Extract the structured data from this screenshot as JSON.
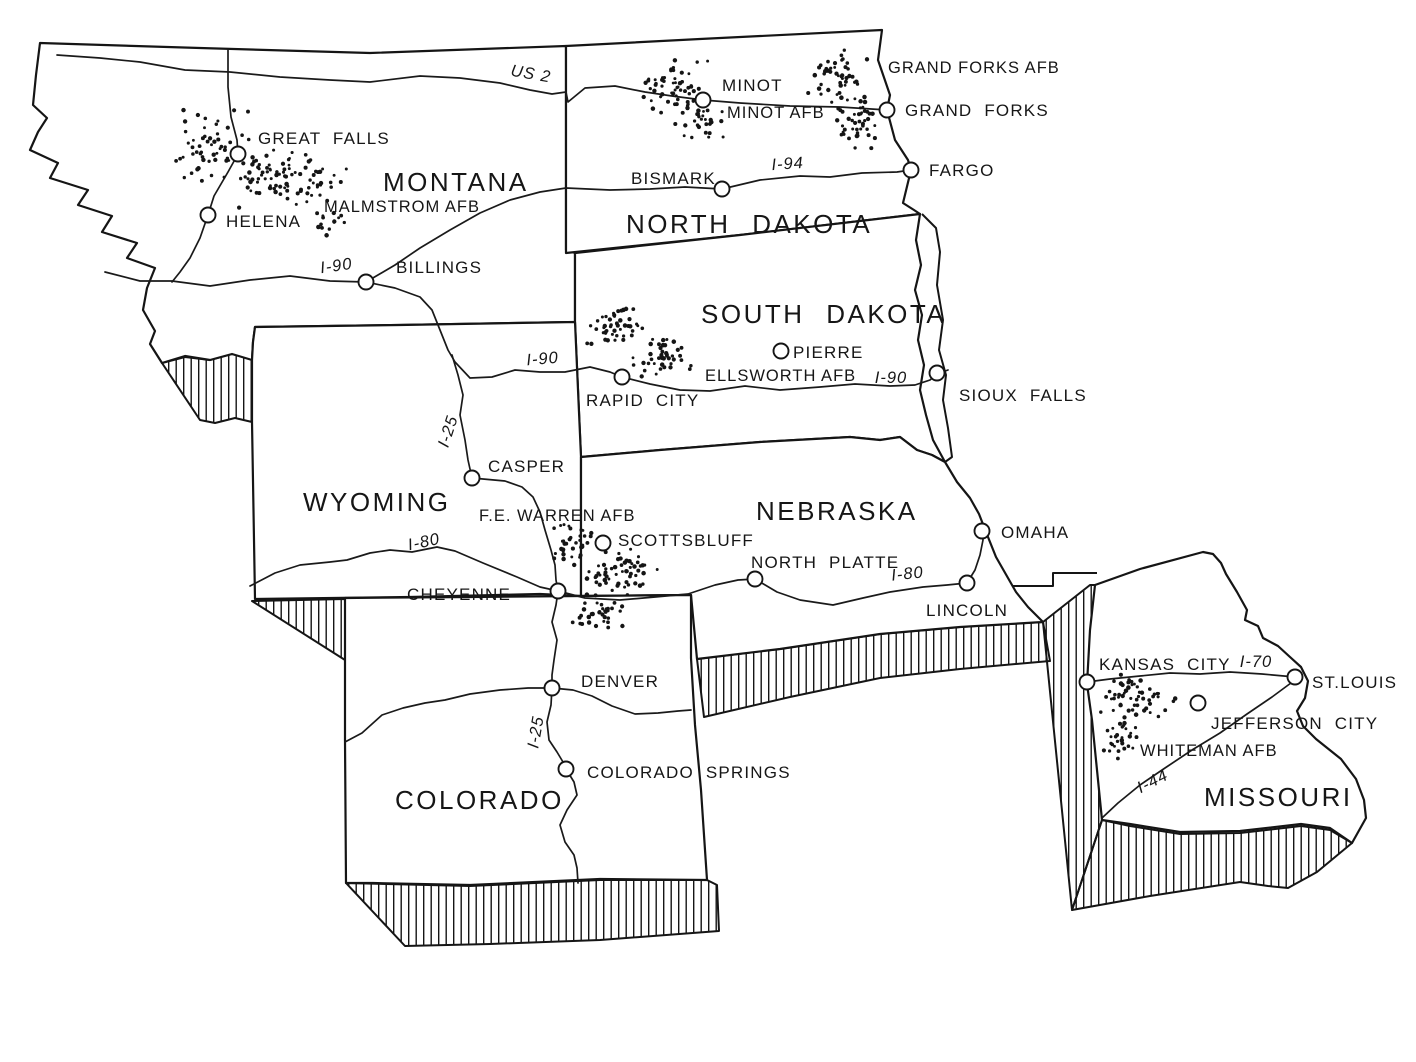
{
  "figure": {
    "background": "#ffffff",
    "ink": "#151515"
  },
  "states": [
    {
      "id": "montana",
      "label": "MONTANA",
      "x": 383,
      "y": 191,
      "size": 27
    },
    {
      "id": "north-dakota",
      "label": "NORTH DAKOTA",
      "x": 626,
      "y": 233,
      "size": 26
    },
    {
      "id": "south-dakota",
      "label": "SOUTH DAKOTA",
      "x": 701,
      "y": 323,
      "size": 26
    },
    {
      "id": "wyoming",
      "label": "WYOMING",
      "x": 303,
      "y": 511,
      "size": 27
    },
    {
      "id": "nebraska",
      "label": "NEBRASKA",
      "x": 756,
      "y": 520,
      "size": 27
    },
    {
      "id": "colorado",
      "label": "COLORADO",
      "x": 395,
      "y": 809,
      "size": 27
    },
    {
      "id": "missouri",
      "label": "MISSOURI",
      "x": 1204,
      "y": 806,
      "size": 26
    }
  ],
  "cities": [
    {
      "id": "great-falls",
      "name": "GREAT FALLS",
      "x": 238,
      "y": 154,
      "lx": 258,
      "ly": 144
    },
    {
      "id": "helena",
      "name": "HELENA",
      "x": 208,
      "y": 215,
      "lx": 226,
      "ly": 227
    },
    {
      "id": "billings",
      "name": "BILLINGS",
      "x": 366,
      "y": 282,
      "lx": 396,
      "ly": 273
    },
    {
      "id": "minot",
      "name": "MINOT",
      "x": 703,
      "y": 100,
      "lx": 722,
      "ly": 91
    },
    {
      "id": "grand-forks",
      "name": "GRAND FORKS",
      "x": 887,
      "y": 110,
      "lx": 905,
      "ly": 116
    },
    {
      "id": "fargo",
      "name": "FARGO",
      "x": 911,
      "y": 170,
      "lx": 929,
      "ly": 176
    },
    {
      "id": "bismark",
      "name": "BISMARK",
      "x": 722,
      "y": 189,
      "lx": 631,
      "ly": 184
    },
    {
      "id": "pierre",
      "name": "PIERRE",
      "x": 781,
      "y": 351,
      "lx": 793,
      "ly": 358
    },
    {
      "id": "rapid-city",
      "name": "RAPID CITY",
      "x": 622,
      "y": 377,
      "lx": 586,
      "ly": 406
    },
    {
      "id": "sioux-falls",
      "name": "SIOUX FALLS",
      "x": 937,
      "y": 373,
      "lx": 959,
      "ly": 401
    },
    {
      "id": "casper",
      "name": "CASPER",
      "x": 472,
      "y": 478,
      "lx": 488,
      "ly": 472
    },
    {
      "id": "scottsbluff",
      "name": "SCOTTSBLUFF",
      "x": 603,
      "y": 543,
      "lx": 618,
      "ly": 546
    },
    {
      "id": "cheyenne",
      "name": "CHEYENNE",
      "x": 558,
      "y": 591,
      "lx": 407,
      "ly": 600
    },
    {
      "id": "north-platte",
      "name": "NORTH PLATTE",
      "x": 755,
      "y": 579,
      "lx": 751,
      "ly": 568
    },
    {
      "id": "omaha",
      "name": "OMAHA",
      "x": 982,
      "y": 531,
      "lx": 1001,
      "ly": 538
    },
    {
      "id": "lincoln",
      "name": "LINCOLN",
      "x": 967,
      "y": 583,
      "lx": 926,
      "ly": 616
    },
    {
      "id": "denver",
      "name": "DENVER",
      "x": 552,
      "y": 688,
      "lx": 581,
      "ly": 687
    },
    {
      "id": "colorado-springs",
      "name": "COLORADO SPRINGS",
      "x": 566,
      "y": 769,
      "lx": 587,
      "ly": 778
    },
    {
      "id": "kansas-city",
      "name": "KANSAS CITY",
      "x": 1087,
      "y": 682,
      "lx": 1099,
      "ly": 670
    },
    {
      "id": "st-louis",
      "name": "ST.LOUIS",
      "x": 1295,
      "y": 677,
      "lx": 1312,
      "ly": 688
    },
    {
      "id": "jefferson-city",
      "name": "JEFFERSON CITY",
      "x": 1198,
      "y": 703,
      "lx": 1211,
      "ly": 729
    }
  ],
  "air_force_bases": [
    {
      "id": "malmstrom-afb",
      "name": "MALMSTROM AFB",
      "lx": 324,
      "ly": 212
    },
    {
      "id": "minot-afb",
      "name": "MINOT AFB",
      "lx": 727,
      "ly": 118
    },
    {
      "id": "grand-forks-afb",
      "name": "GRAND FORKS AFB",
      "lx": 888,
      "ly": 73
    },
    {
      "id": "ellsworth-afb",
      "name": "ELLSWORTH AFB",
      "lx": 705,
      "ly": 381
    },
    {
      "id": "fe-warren-afb",
      "name": "F.E. WARREN AFB",
      "lx": 479,
      "ly": 521
    },
    {
      "id": "whiteman-afb",
      "name": "WHITEMAN AFB",
      "lx": 1140,
      "ly": 756
    }
  ],
  "highway_labels": [
    {
      "id": "us-2",
      "text": "US 2",
      "x": 530,
      "y": 79,
      "rot": 10
    },
    {
      "id": "i-90-mt",
      "text": "I-90",
      "x": 337,
      "y": 271,
      "rot": -8
    },
    {
      "id": "i-94",
      "text": "I-94",
      "x": 788,
      "y": 169,
      "rot": -4
    },
    {
      "id": "i-90-sd-w",
      "text": "I-90",
      "x": 543,
      "y": 364,
      "rot": -5
    },
    {
      "id": "i-90-sd-e",
      "text": "I-90",
      "x": 891,
      "y": 383,
      "rot": 0
    },
    {
      "id": "i-25-wy",
      "text": "I-25",
      "x": 453,
      "y": 433,
      "rot": -72
    },
    {
      "id": "i-80-wy",
      "text": "I-80",
      "x": 425,
      "y": 547,
      "rot": -12
    },
    {
      "id": "i-80-ne",
      "text": "I-80",
      "x": 908,
      "y": 579,
      "rot": -6
    },
    {
      "id": "i-25-co",
      "text": "I-25",
      "x": 541,
      "y": 733,
      "rot": -80
    },
    {
      "id": "i-70-mo",
      "text": "I-70",
      "x": 1256,
      "y": 667,
      "rot": 0
    },
    {
      "id": "i-44-mo",
      "text": "I-44",
      "x": 1155,
      "y": 786,
      "rot": -27
    }
  ],
  "missile_fields": [
    {
      "id": "malmstrom-field",
      "seed": 11,
      "lobes": [
        [
          212,
          146,
          40,
          44,
          55
        ],
        [
          298,
          182,
          62,
          32,
          72
        ],
        [
          258,
          166,
          26,
          20,
          20
        ],
        [
          332,
          222,
          18,
          16,
          14
        ]
      ]
    },
    {
      "id": "minot-field",
      "seed": 22,
      "lobes": [
        [
          676,
          90,
          36,
          34,
          58
        ],
        [
          700,
          122,
          26,
          18,
          26
        ]
      ]
    },
    {
      "id": "grand-forks-field",
      "seed": 33,
      "lobes": [
        [
          838,
          74,
          32,
          30,
          46
        ],
        [
          852,
          122,
          28,
          30,
          44
        ]
      ]
    },
    {
      "id": "ellsworth-field",
      "seed": 44,
      "lobes": [
        [
          617,
          326,
          36,
          22,
          45
        ],
        [
          661,
          358,
          32,
          22,
          42
        ]
      ]
    },
    {
      "id": "fe-warren-field",
      "seed": 55,
      "lobes": [
        [
          571,
          545,
          27,
          27,
          36
        ],
        [
          623,
          573,
          41,
          26,
          58
        ],
        [
          602,
          614,
          34,
          20,
          34
        ]
      ]
    },
    {
      "id": "whiteman-field",
      "seed": 66,
      "lobes": [
        [
          1141,
          698,
          41,
          25,
          54
        ],
        [
          1121,
          742,
          23,
          22,
          28
        ]
      ]
    }
  ]
}
